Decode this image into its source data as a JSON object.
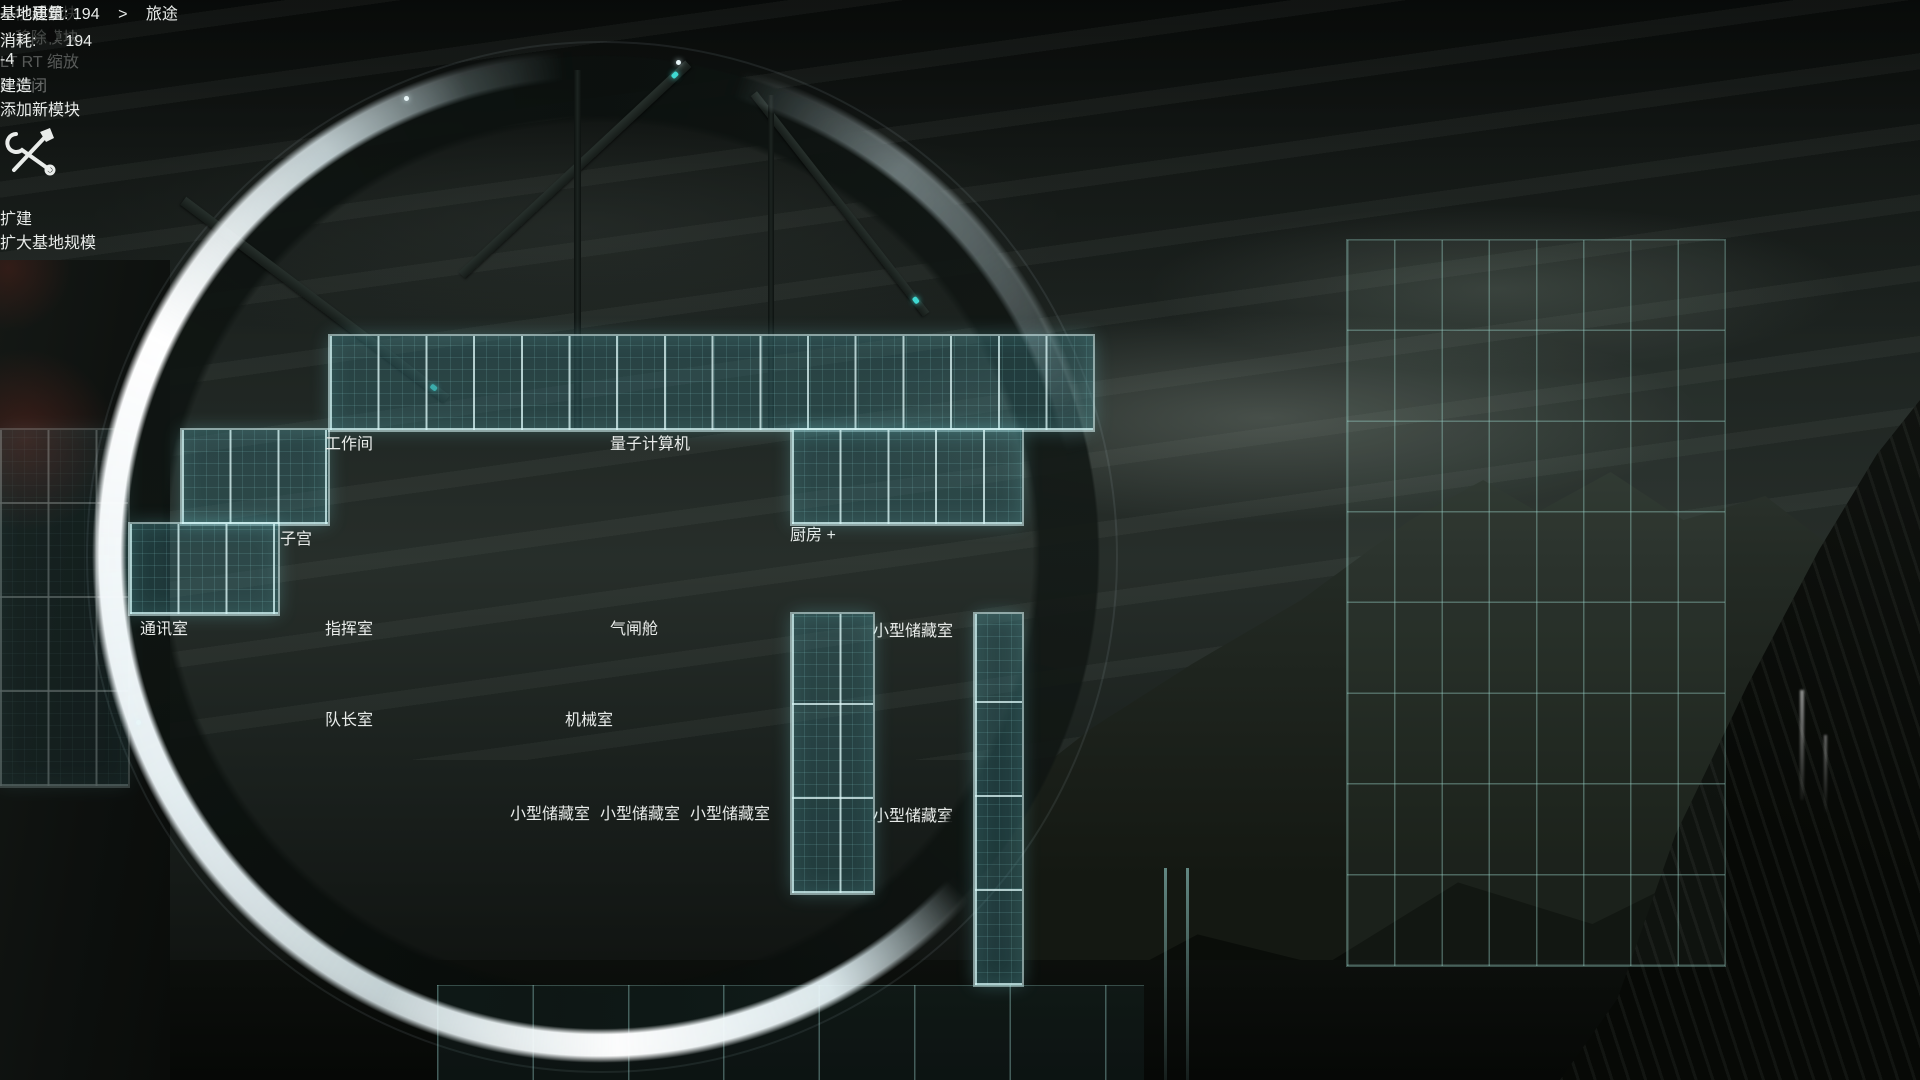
{
  "title": "基地建筑",
  "menu": {
    "build": {
      "label": "建造",
      "subtitle": "添加新模块",
      "icon": "hammer-wrench",
      "hint_icon": "dpad-up"
    },
    "expand": {
      "label": "扩建",
      "subtitle": "扩大基地规模",
      "icon": "gear-ring",
      "hint_icon": "dpad-down"
    }
  },
  "rooms": [
    {
      "label": "工作间",
      "highlight": "none"
    },
    {
      "label": "量子计算机",
      "highlight": "none"
    },
    {
      "label": "子宫",
      "highlight": "none"
    },
    {
      "label": "厨房",
      "highlight": "green",
      "add_button": "+"
    },
    {
      "label": "通讯室",
      "highlight": "none"
    },
    {
      "label": "指挥室",
      "highlight": "none"
    },
    {
      "label": "气闸舱",
      "highlight": "none"
    },
    {
      "label": "小型储藏室",
      "highlight": "red"
    },
    {
      "label": "队长室",
      "highlight": "none"
    },
    {
      "label": "机械室",
      "highlight": "none"
    },
    {
      "label": "小型储藏室",
      "highlight": "red"
    },
    {
      "label": "小型储藏室",
      "highlight": "red"
    },
    {
      "label": "小型储藏室",
      "highlight": "red"
    },
    {
      "label": "小型储藏室",
      "highlight": "red"
    }
  ],
  "resources": [
    {
      "icon": "metal-nugget",
      "value": "007",
      "label": "金属"
    },
    {
      "icon": "gas-burst",
      "value": "050",
      "label": "異气"
    },
    {
      "icon": "mineral-diamond",
      "value": "000",
      "label": "矿物质"
    },
    {
      "icon": "metal-rich-sparkle",
      "value": "000",
      "label": "金属富集物"
    },
    {
      "icon": "food-carrot",
      "value": "002",
      "label": "食材"
    },
    {
      "icon": "mush-bowl",
      "value": "015",
      "label": "糊糊"
    },
    {
      "icon": "dish-pot",
      "value": "000",
      "label": "烹饪菜肴"
    }
  ],
  "capacity": {
    "storage_value": "258.00/600.00",
    "storage_label": "储藏室",
    "organics_value": "246/300",
    "organics_label": "有机物",
    "organics_icon": "droplet"
  },
  "stats": {
    "mass_label": "基地质量:",
    "mass_value": "194",
    "mass_delta": "-4",
    "mass_icon": "weight",
    "arrow": ">",
    "journey_label_line1": "旅途",
    "journey_label_line2": "消耗:",
    "journey_icon": "droplet",
    "journey_value": "194"
  },
  "controls": {
    "move": {
      "key": "A",
      "label": "移动模块",
      "enabled": true
    },
    "remove": {
      "key": "Y",
      "label": "移除模块",
      "enabled": false
    },
    "zoom": {
      "key1": "LT",
      "key2": "RT",
      "label": "缩放"
    },
    "close": {
      "key": "B",
      "label": "关闭"
    }
  },
  "colors": {
    "grid_teal": "#8fe3df",
    "highlight_green": "#3fe6a8",
    "highlight_orange": "#ff6c32",
    "delta_gold": "#e0a93e"
  }
}
